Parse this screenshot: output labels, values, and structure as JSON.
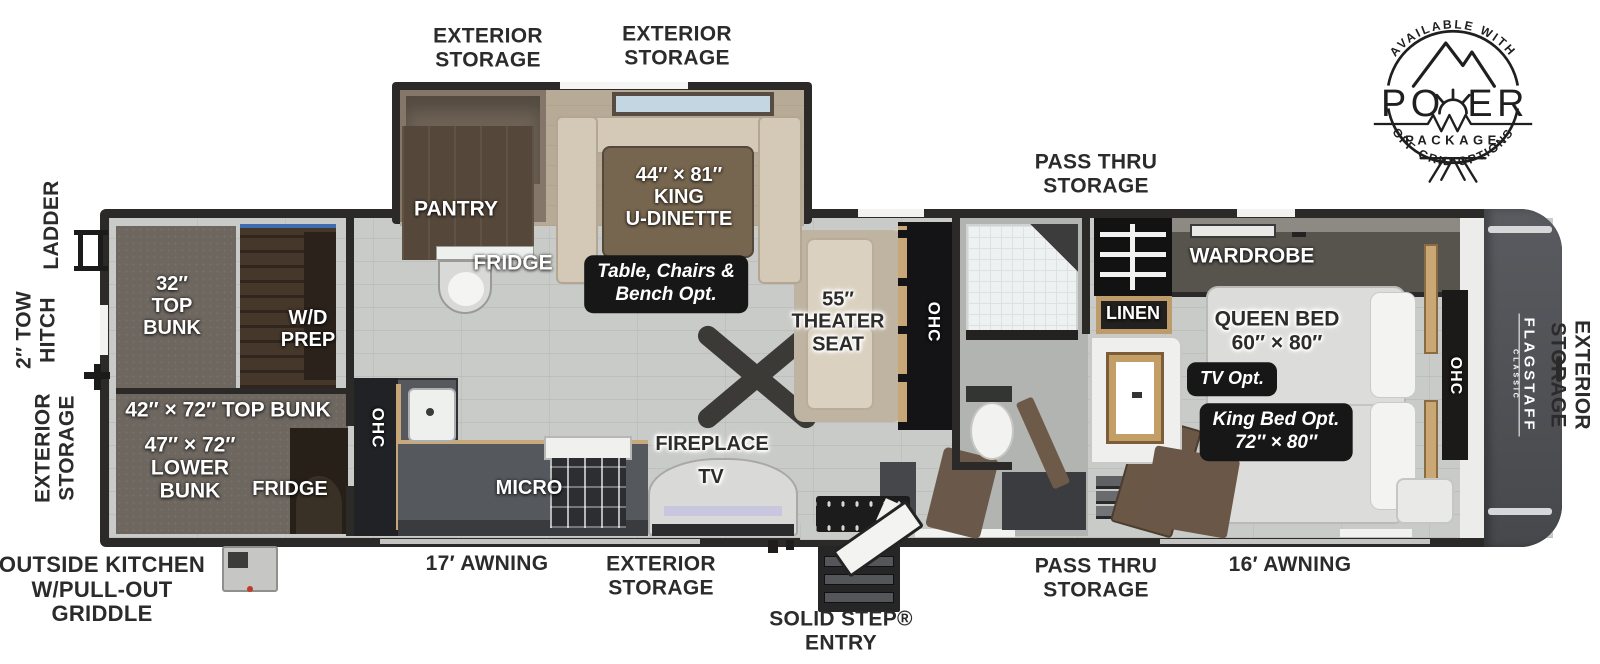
{
  "brand": {
    "name": "FLAGSTAFF",
    "sub": "CLASSIC"
  },
  "logo": {
    "top_arc": "AVAILABLE WITH",
    "po": "PO",
    "er": "ER",
    "package": "PACKAGE",
    "bottom_arc": "OFF-GRID OPTIONS"
  },
  "exterior": {
    "storage_top_left": "EXTERIOR\nSTORAGE",
    "storage_top_mid": "EXTERIOR\nSTORAGE",
    "pass_thru_top": "PASS THRU\nSTORAGE",
    "ladder": "LADDER",
    "tow_hitch": "2″ TOW\nHITCH",
    "storage_left": "EXTERIOR\nSTORAGE",
    "storage_right": "EXTERIOR\nSTORAGE",
    "outside_kitchen": "OUTSIDE KITCHEN\nW/PULL-OUT\nGRIDDLE",
    "awning_17": "17′ AWNING",
    "storage_bottom": "EXTERIOR\nSTORAGE",
    "solid_step": "SOLID STEP®\nENTRY",
    "pass_thru_bottom": "PASS THRU\nSTORAGE",
    "awning_16": "16′ AWNING"
  },
  "interior": {
    "top_bunk_32": "32″\nTOP\nBUNK",
    "wd_prep": "W/D\nPREP",
    "top_bunk_42": "42″ × 72″ TOP BUNK",
    "lower_bunk_47": "47″ × 72″\nLOWER\nBUNK",
    "fridge_bunk": "FRIDGE",
    "pantry": "PANTRY",
    "fridge": "FRIDGE",
    "king_u_dinette": "44″ × 81″\nKING\nU-DINETTE",
    "dinette_option": "Table, Chairs &\nBench Opt.",
    "theater_seat": "55″\nTHEATER\nSEAT",
    "ohc_theater": "OHC",
    "ohc_kitchen": "OHC",
    "ohc_bedroom": "OHC",
    "micro": "MICRO",
    "fireplace": "FIREPLACE",
    "tv": "TV",
    "wardrobe": "WARDROBE",
    "linen": "LINEN",
    "queen_bed": "QUEEN BED\n60″ × 80″",
    "tv_option": "TV Opt.",
    "king_bed_option": "King Bed Opt.\n72″ × 80″"
  }
}
